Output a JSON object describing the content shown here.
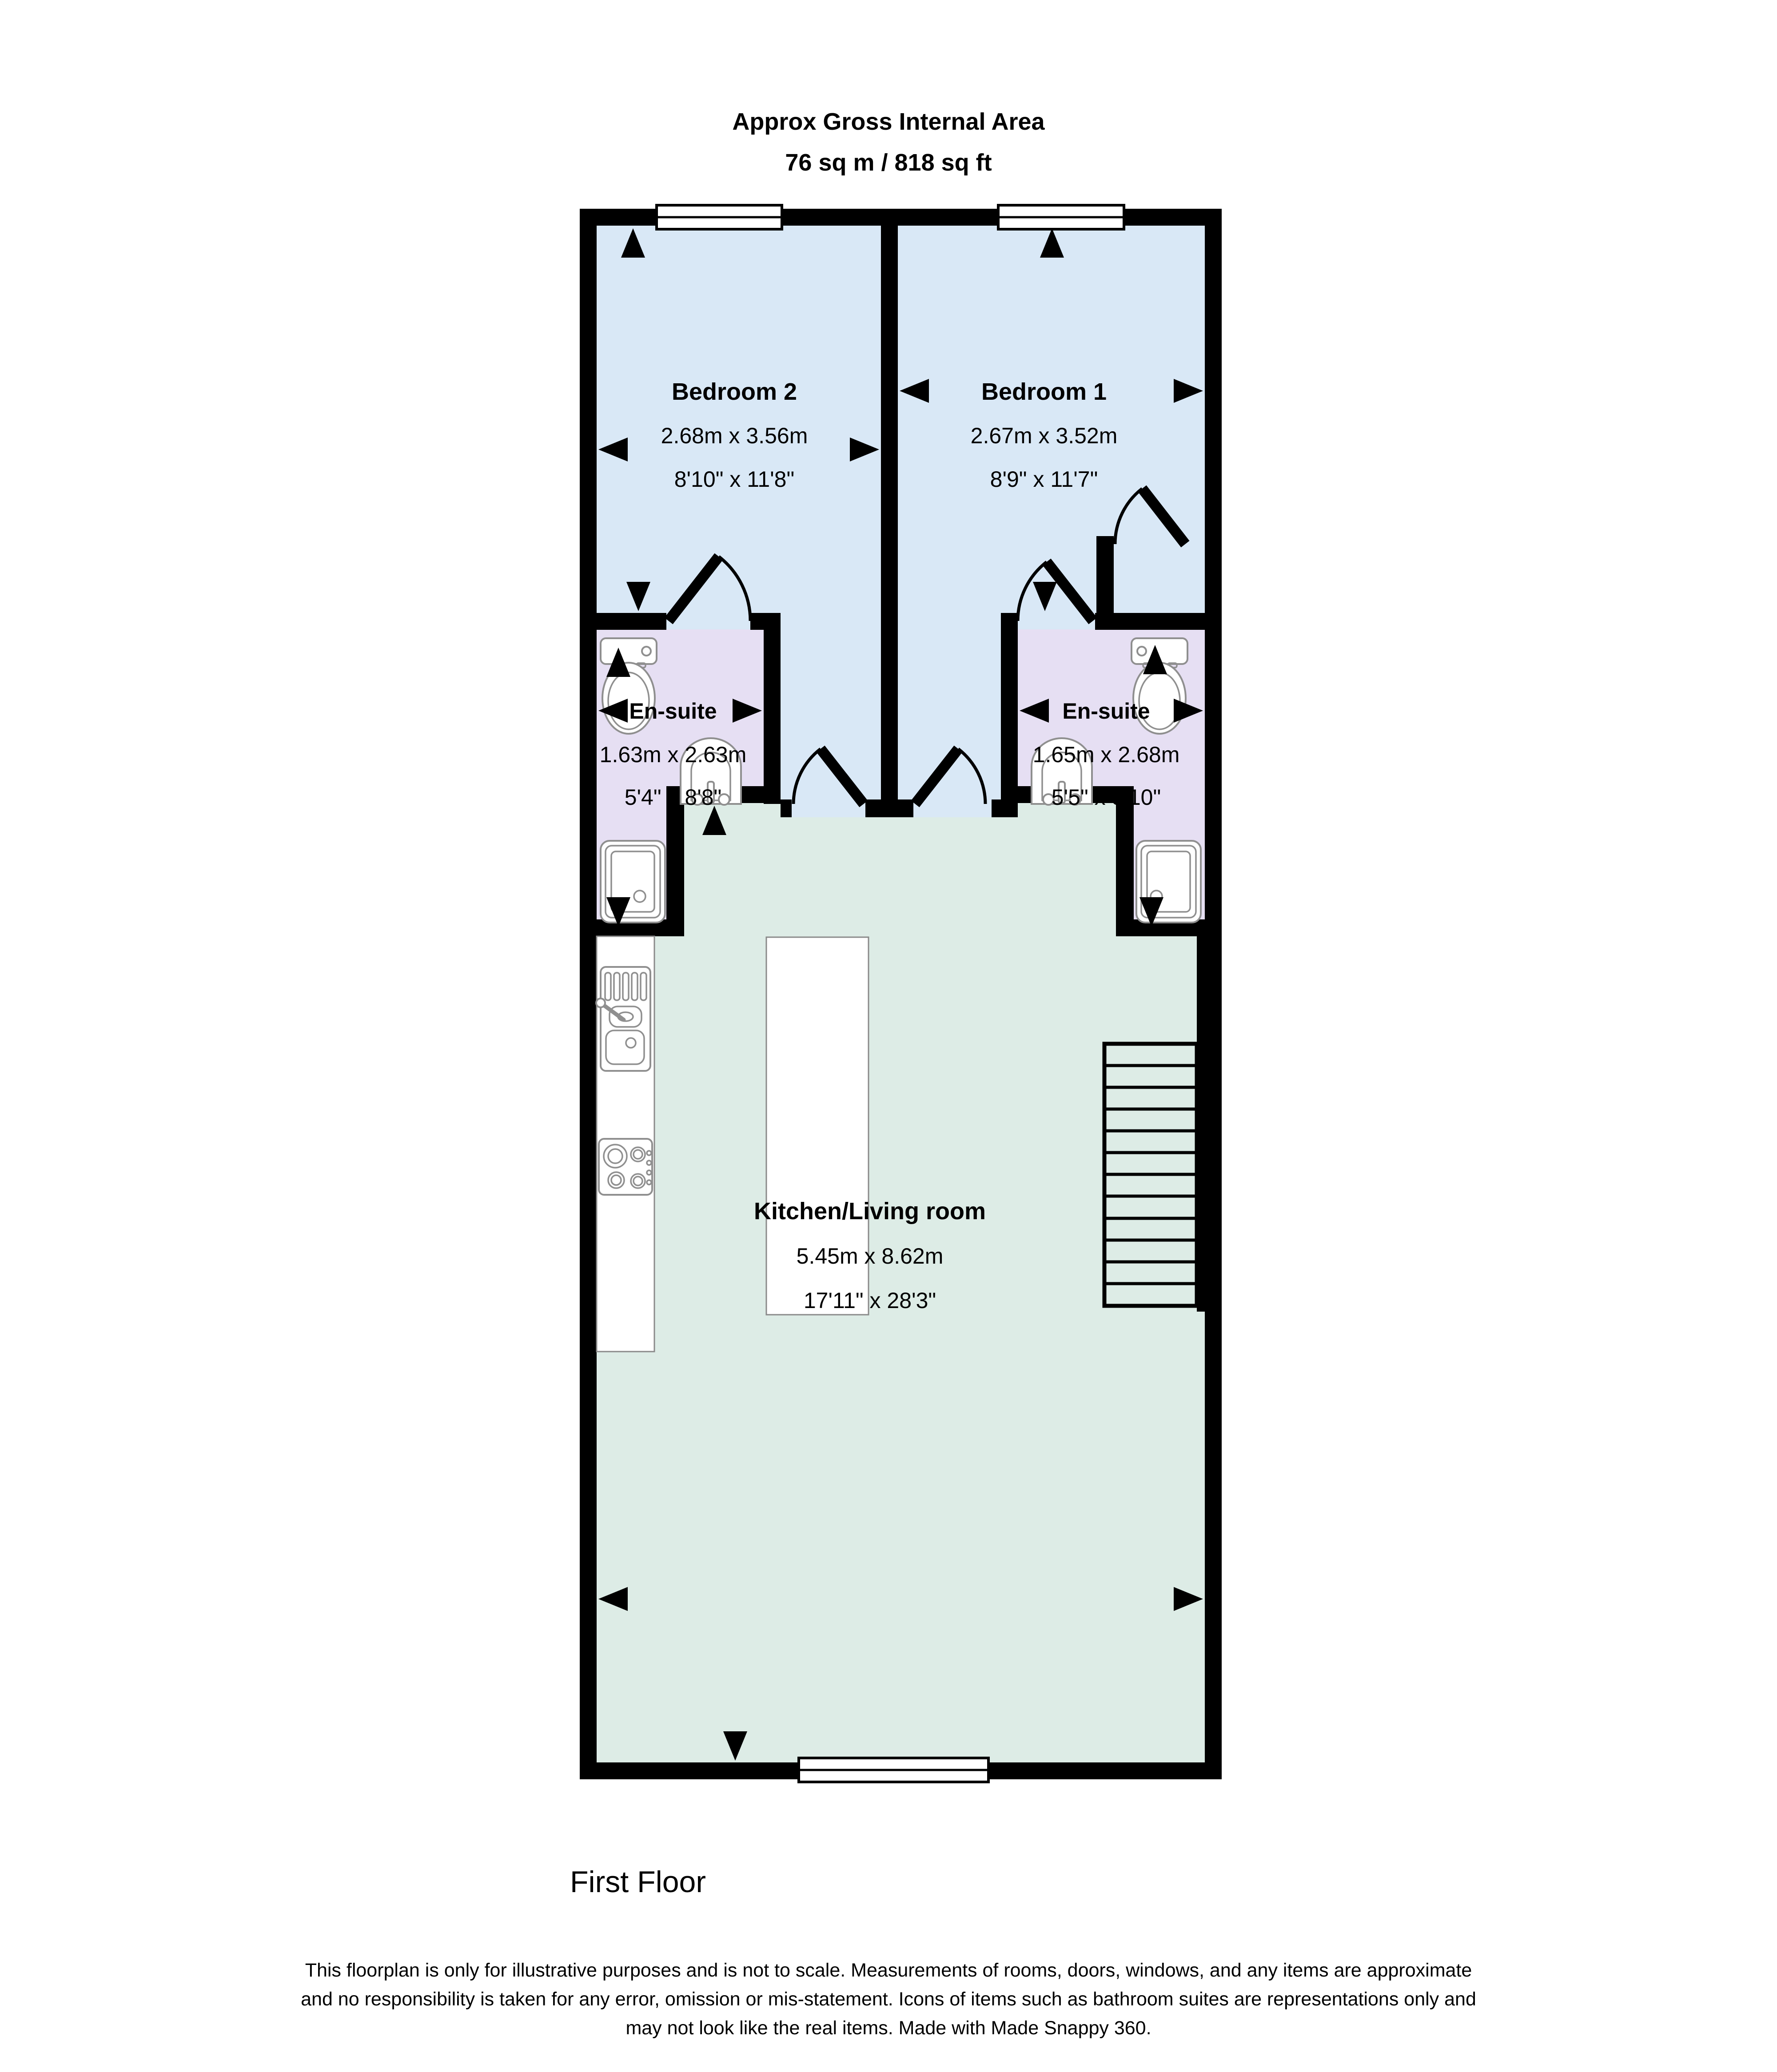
{
  "header": {
    "title": "Approx Gross Internal Area",
    "area": "76 sq m / 818 sq ft"
  },
  "floor_label": "First Floor",
  "rooms": {
    "bedroom2": {
      "name": "Bedroom 2",
      "dims_m": "2.68m x 3.56m",
      "dims_ft": "8'10\" x 11'8\""
    },
    "bedroom1": {
      "name": "Bedroom 1",
      "dims_m": "2.67m x 3.52m",
      "dims_ft": "8'9\" x 11'7\""
    },
    "ensuite_left": {
      "name": "En-suite",
      "dims_m": "1.63m x 2.63m",
      "dims_ft": "5'4\" x 8'8\""
    },
    "ensuite_right": {
      "name": "En-suite",
      "dims_m": "1.65m x 2.68m",
      "dims_ft": "5'5\" x 8'10\""
    },
    "kitchen_living": {
      "name": "Kitchen/Living room",
      "dims_m": "5.45m x 8.62m",
      "dims_ft": "17'11\" x 28'3\""
    }
  },
  "disclaimer": {
    "line1": "This floorplan is only for illustrative purposes and is not to scale. Measurements of rooms, doors, windows, and any items are approximate",
    "line2": "and no responsibility is taken for any error, omission or mis-statement. Icons of items such as bathroom suites are representations only and",
    "line3": "may not look like the real items. Made with Made Snappy 360."
  },
  "colors": {
    "bedroom_fill": "#d9e8f6",
    "ensuite_fill": "#e6dff3",
    "kitchen_fill": "#ddece6",
    "wall": "#000000"
  }
}
